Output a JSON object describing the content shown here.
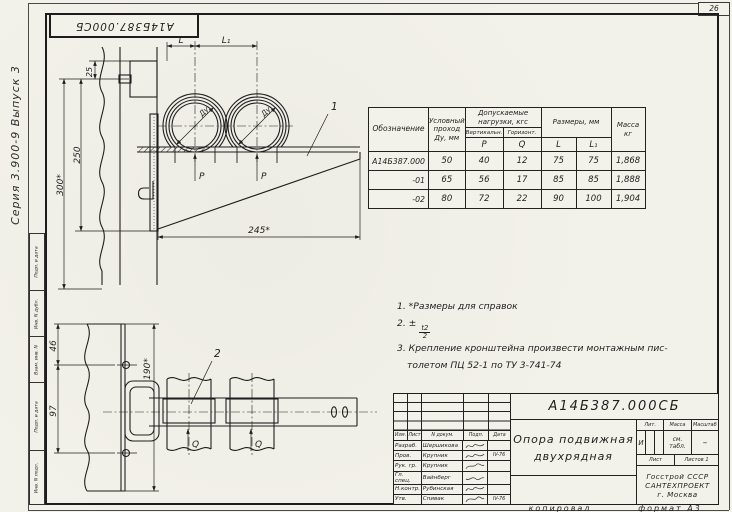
{
  "page": {
    "sheet_number": "26",
    "copy_label": "копировал",
    "format_label": "формат А3",
    "series_note": "Серия 3.900-9 Выпуск 3",
    "top_stamp": "А14Б387.000СБ"
  },
  "margin_stamp": {
    "cells": [
      "Подп. и дата",
      "Инв. N дубл.",
      "Взам. инв. N",
      "Подп. и дата",
      "Инв. N подл."
    ]
  },
  "views": {
    "front": {
      "dim_l": "L",
      "dim_l1": "L₁",
      "dim_offset": "25",
      "dim_height": "250",
      "dim_total_height": "300*",
      "dim_length": "245*",
      "pipe_dia": "Ду",
      "load_vertical": "P",
      "callout_bracket": "1"
    },
    "plan": {
      "dim_top": "46",
      "dim_mid": "97",
      "dim_width": "190*",
      "load_horizontal": "Q",
      "callout_clamp": "2"
    }
  },
  "spec_table": {
    "headers": {
      "designation": "Обозначение",
      "passage_l1": "Условный",
      "passage_l2": "проход",
      "passage_l3": "Ду, мм",
      "loads": "Допускаемые нагрузки, кгс",
      "loads_vert": "Вертикальн.",
      "loads_horiz": "Горизонт.",
      "p": "P",
      "q": "Q",
      "dims": "Размеры, мм",
      "l": "L",
      "l1": "L₁",
      "mass_l1": "Масса",
      "mass_l2": "кг"
    },
    "rows": [
      {
        "designation": "А14Б387.000",
        "du": "50",
        "p": "40",
        "q": "12",
        "l": "75",
        "l1": "75",
        "mass": "1,868"
      },
      {
        "designation": "-01",
        "du": "65",
        "p": "56",
        "q": "17",
        "l": "85",
        "l1": "85",
        "mass": "1,888"
      },
      {
        "designation": "-02",
        "du": "80",
        "p": "72",
        "q": "22",
        "l": "90",
        "l1": "100",
        "mass": "1,904"
      }
    ]
  },
  "notes": {
    "n1": "1. *Размеры для справок",
    "n2_prefix": "2. ±",
    "n2_frac_num": "t2",
    "n2_frac_den": "2",
    "n3_line1": "3. Крепление кронштейна произвести монтажным пис-",
    "n3_line2": "толетом ПЦ 52-1 по ТУ 3-741-74"
  },
  "title_block": {
    "doc_number": "А14Б387.000СБ",
    "title_line1": "Опора подвижная",
    "title_line2": "двухрядная",
    "cols": {
      "izm": "Изм.",
      "list": "Лист",
      "doc": "N докум.",
      "sign": "Подп.",
      "date": "Дата"
    },
    "sign_rows": [
      {
        "role": "Разраб.",
        "name": "Шершикова",
        "date": ""
      },
      {
        "role": "Пров.",
        "name": "Крупник",
        "date": "IV-76"
      },
      {
        "role": "Рук. гр.",
        "name": "Крупник",
        "date": ""
      },
      {
        "role": "Гл. спец.",
        "name": "Вайнберг",
        "date": ""
      },
      {
        "role": "Н.контр.",
        "name": "Рубинская",
        "date": ""
      },
      {
        "role": "Утв.",
        "name": "Спивак",
        "date": "IV-76"
      }
    ],
    "lit_label": "Лит.",
    "mass_label": "Масса",
    "scale_label": "Масштаб",
    "lit_value": "И",
    "mass_value_l1": "см.",
    "mass_value_l2": "табл.",
    "scale_value": "–",
    "sheet_label": "Лист",
    "sheets_label": "Листов 1",
    "org_line1": "Госстрой СССР",
    "org_line2": "САНТЕХПРОЕКТ",
    "org_line3": "г. Москва"
  }
}
